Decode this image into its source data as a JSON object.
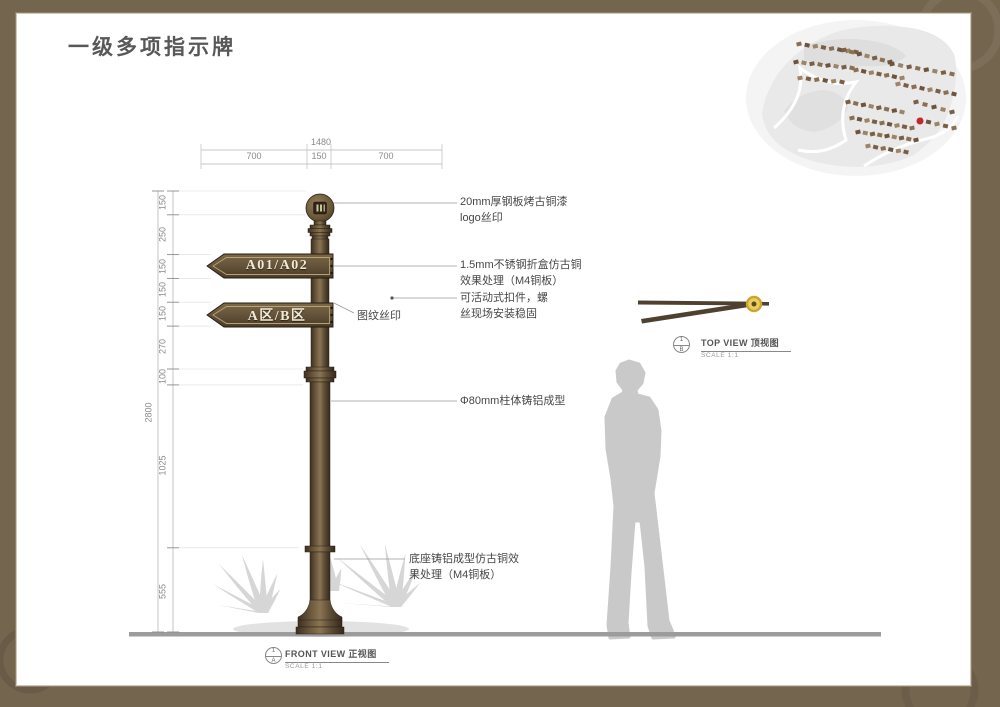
{
  "title": "一级多项指示牌",
  "sign": {
    "panel_top": "A01/A02",
    "panel_bottom": "A区/B区"
  },
  "dimensions": {
    "top_overall": "1480",
    "top_segments": [
      "700",
      "150",
      "700"
    ],
    "left_overall": "2800",
    "left_segments": [
      "150",
      "250",
      "150",
      "150",
      "150",
      "270",
      "100",
      "1025",
      "555"
    ]
  },
  "annotations": {
    "logo": [
      "20mm厚钢板烤古铜漆",
      "logo丝印"
    ],
    "panel": [
      "1.5mm不锈钢折盒仿古铜",
      "效果处理（M4铜板）"
    ],
    "clamp": [
      "可活动式扣件，螺",
      "丝现场安装稳固"
    ],
    "pattern": [
      "图纹丝印"
    ],
    "pole": [
      "Φ80mm柱体铸铝成型"
    ],
    "base": [
      "底座铸铝成型仿古铜效",
      "果处理（M4铜板）"
    ]
  },
  "views": {
    "front": {
      "num": "1",
      "ref": "A",
      "title": "FRONT VIEW 正视图",
      "scale": "SCALE 1:1"
    },
    "top": {
      "num": "1",
      "ref": "B",
      "title": "TOP VIEW 顶视图",
      "scale": "SCALE 1:1"
    }
  },
  "colors": {
    "bronze": "#5e4d37",
    "bronze_dark": "#34291c",
    "bronze_light": "#8a7452",
    "gold": "#e7cf63",
    "frame": "#74654f",
    "silhouette": "#c9c9c9",
    "ground": "#9c9c9c",
    "marker_red": "#c1272d",
    "panel_text": "#f2ead4"
  }
}
